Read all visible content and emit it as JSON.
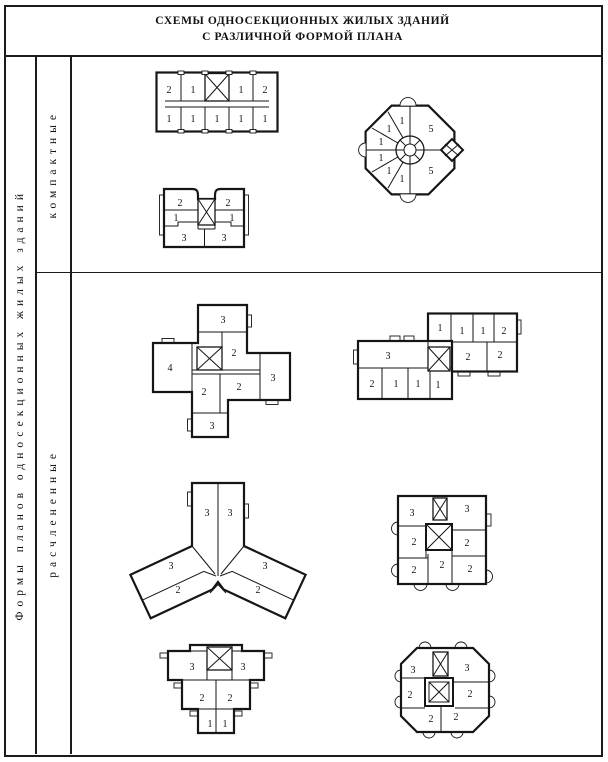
{
  "title": {
    "line1": "СХЕМЫ ОДНОСЕКЦИОННЫХ ЖИЛЫХ ЗДАНИЙ",
    "line2": "С РАЗЛИЧНОЙ ФОРМОЙ ПЛАНА"
  },
  "sidebar": {
    "label": "Формы планов односекционных жилых зданий"
  },
  "sections": [
    {
      "id": "compact",
      "label": "компактные"
    },
    {
      "id": "dissected",
      "label": "расчлененные"
    }
  ],
  "colors": {
    "ink": "#161616",
    "paper": "#ffffff"
  },
  "plans": {
    "a": {
      "name": "rectangular-corridor-plan",
      "labels": [
        "2",
        "1",
        "1",
        "2",
        "1",
        "1",
        "1",
        "1",
        "1"
      ]
    },
    "b": {
      "name": "round-plan",
      "labels": [
        "1",
        "1",
        "1",
        "1",
        "1",
        "1",
        "5",
        "5"
      ]
    },
    "c": {
      "name": "notched-rectangular-plan",
      "labels": [
        "2",
        "1",
        "3",
        "2",
        "1",
        "3"
      ]
    },
    "d": {
      "name": "large-pinwheel-plan",
      "labels": [
        "3",
        "2",
        "4",
        "3",
        "2",
        "2",
        "3"
      ]
    },
    "e": {
      "name": "offset-slabs-plan",
      "labels": [
        "1",
        "1",
        "1",
        "2",
        "2",
        "2",
        "3",
        "2",
        "1",
        "1",
        "1"
      ]
    },
    "f": {
      "name": "three-wing-y-plan",
      "labels": [
        "3",
        "3",
        "3",
        "2",
        "3",
        "2"
      ]
    },
    "g": {
      "name": "small-pinwheel-plan",
      "labels": [
        "3",
        "3",
        "2",
        "2",
        "2",
        "2",
        "2"
      ]
    },
    "h": {
      "name": "stepped-pyramid-plan",
      "labels": [
        "3",
        "3",
        "2",
        "2",
        "1",
        "1"
      ]
    },
    "i": {
      "name": "scalloped-square-plan",
      "labels": [
        "3",
        "3",
        "2",
        "2",
        "2",
        "2"
      ]
    }
  }
}
